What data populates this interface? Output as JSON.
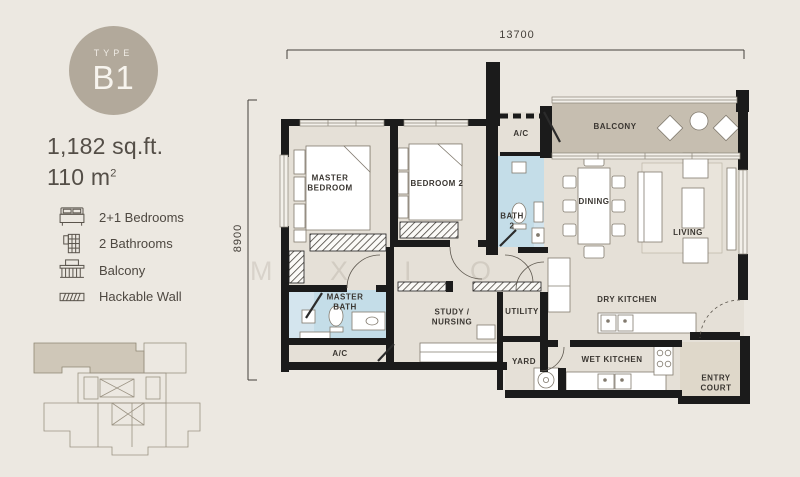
{
  "panel": {
    "badge": {
      "top_label": "TYPE",
      "code": "B1"
    },
    "area_sqft": "1,182 sq.ft.",
    "area_m2_base": "110 m",
    "area_m2_sup": "2",
    "features": [
      {
        "icon": "bed-icon",
        "label": "2+1 Bedrooms"
      },
      {
        "icon": "bathrooms-icon",
        "label": "2 Bathrooms"
      },
      {
        "icon": "balcony-icon",
        "label": "Balcony"
      },
      {
        "icon": "hackable-wall-icon",
        "label": "Hackable Wall"
      }
    ]
  },
  "plan": {
    "dim_top": "13700",
    "dim_left": "8900",
    "labels": {
      "master_bedroom": "MASTER BEDROOM",
      "bedroom2": "BEDROOM 2",
      "ac_top": "A/C",
      "bath2": "BATH 2",
      "balcony": "BALCONY",
      "dining": "DINING",
      "living": "LIVING",
      "master_bath": "MASTER BATH",
      "ac_bottom": "A/C",
      "study": "STUDY / NURSING",
      "utility": "UTILITY",
      "yard": "YARD",
      "dry_kitchen": "DRY KITCHEN",
      "wet_kitchen": "WET KITCHEN",
      "entry_court": "ENTRY COURT"
    },
    "watermark_letters": [
      "M",
      "X",
      "I",
      "O"
    ]
  },
  "colors": {
    "wall": "#1B1B1B",
    "floor": "#E5E0D7",
    "balcony_floor": "#C6BEB0",
    "bath_floor": "#C4DDE8",
    "entry_floor": "#DFD8CA",
    "badge": "#B2A99B",
    "text": "#4E4841"
  }
}
